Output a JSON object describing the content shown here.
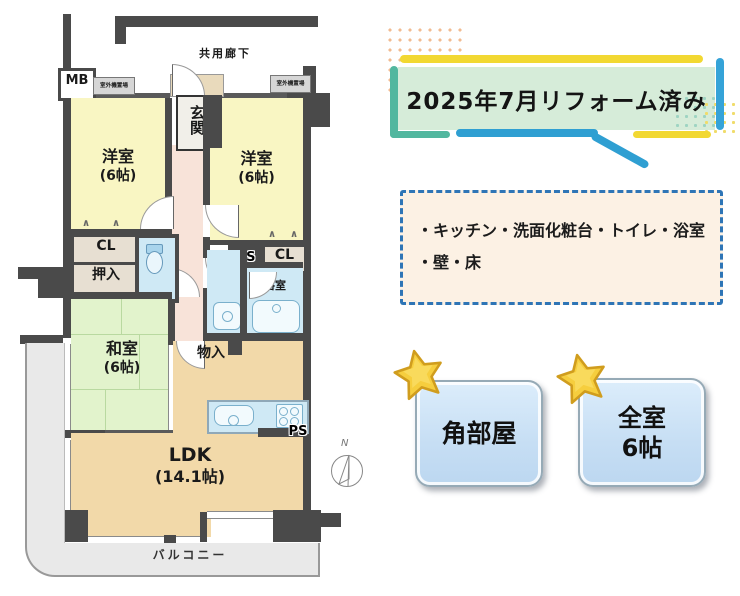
{
  "floorplan": {
    "corridor": "共用廊下",
    "mb": "MB",
    "outdoor_unit": "室外機置場",
    "entrance": "玄関",
    "western_room": "洋室",
    "six_mat": "(6帖)",
    "japanese_room": "和室",
    "ldk": "LDK",
    "ldk_size": "(14.1帖)",
    "closet": "CL",
    "oshiire": "押入",
    "bathroom": "浴室",
    "storage": "物入",
    "ps": "PS",
    "balcony": "バルコニー",
    "compass_north": "N",
    "closet_mark": "∧"
  },
  "banner": {
    "title": "2025年7月リフォーム済み"
  },
  "renovation_box": {
    "line1": "・キッチン・洗面化粧台・トイレ・浴室",
    "line2": "・壁・床"
  },
  "badges": [
    {
      "label": "角部屋"
    },
    {
      "line1": "全室",
      "line2": "6帖"
    }
  ],
  "colors": {
    "wall": "#4a4a4a",
    "room_yellow": "#f9f6c3",
    "tatami_green": "#e2f3cc",
    "ldk_tan": "#f2d9a9",
    "hallway_pink": "#f8e3d9",
    "water_blue": "#cfe9f5",
    "closet_beige": "#e7dfd2",
    "balcony_gray": "#e9e9e9",
    "banner_green": "#d6ecd9",
    "accent_yellow": "#f2d832",
    "accent_blue": "#35a3d8",
    "accent_teal": "#52b79f",
    "dashed_border_blue": "#2e75b6",
    "box_cream": "#fcf1e4",
    "badge_blue": "#c9e0f4",
    "star_gold": "#f6ce3e"
  }
}
